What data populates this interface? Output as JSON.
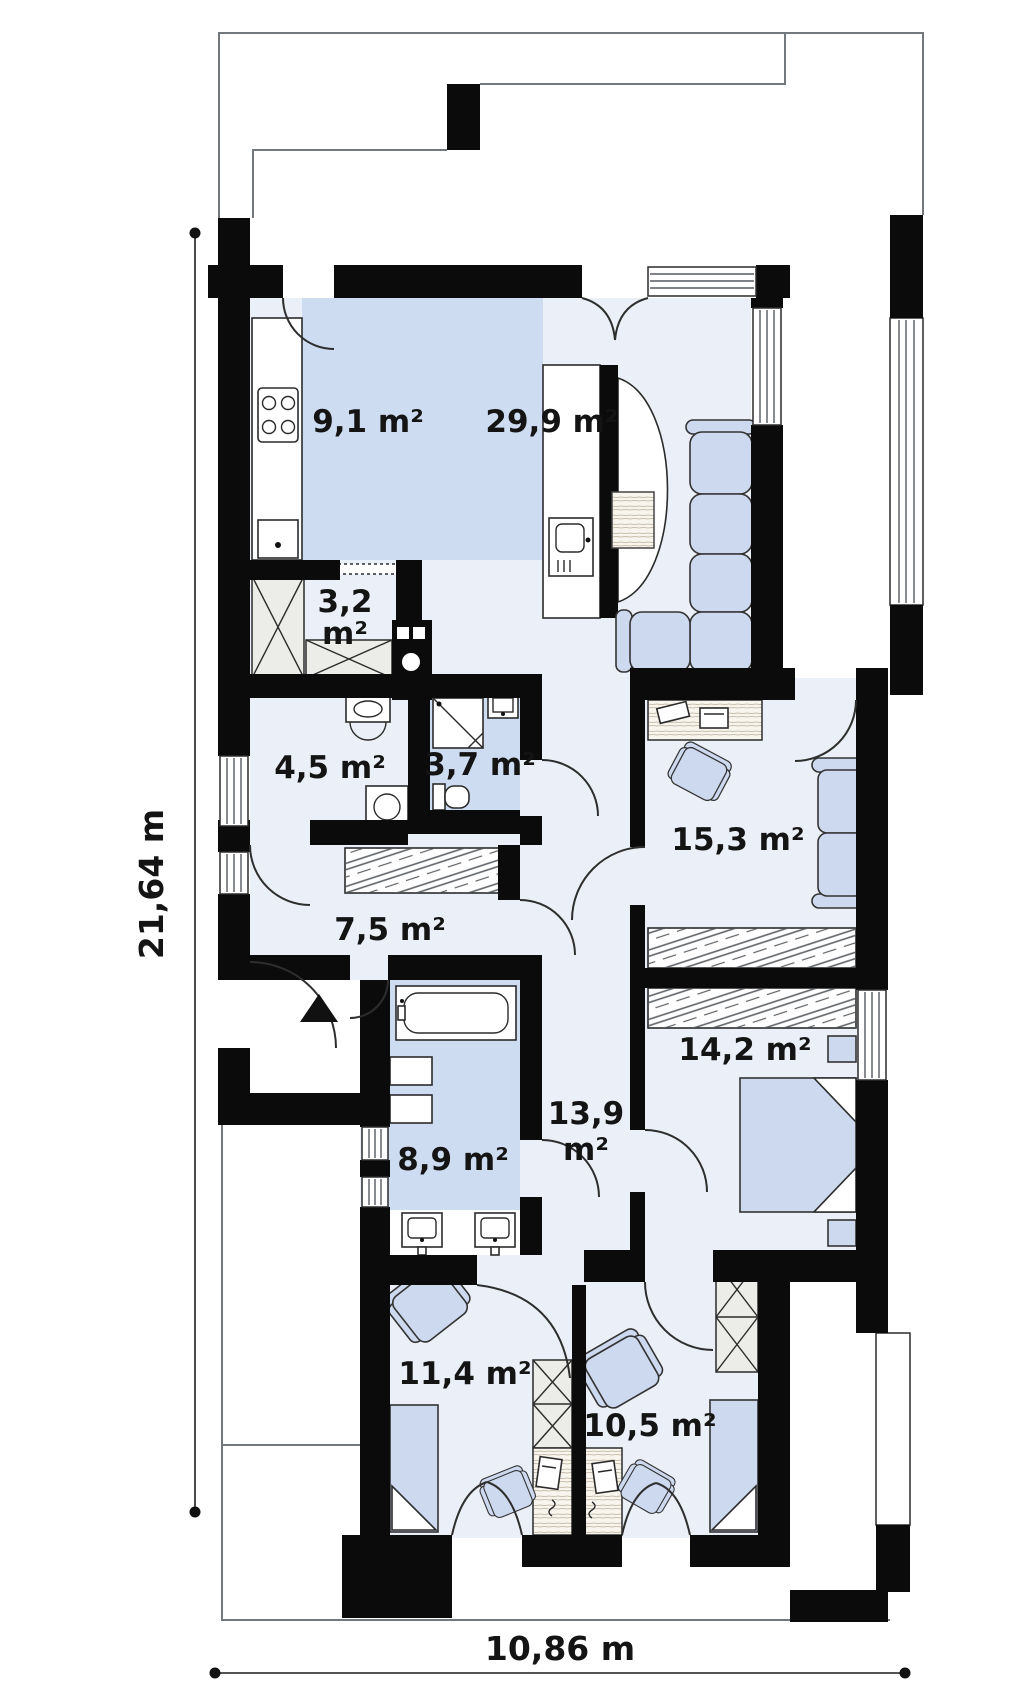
{
  "page": {
    "title": "Single-storey house floor plan"
  },
  "dimensions": {
    "height_label": "21,64 m",
    "width_label": "10,86 m"
  },
  "rooms": [
    {
      "id": "kitchen",
      "label": "9,1 m²"
    },
    {
      "id": "living-room",
      "label": "29,9 m²"
    },
    {
      "id": "pantry",
      "label": "3,2",
      "label2": "m²"
    },
    {
      "id": "utility-room",
      "label": "4,5 m²"
    },
    {
      "id": "shower-room",
      "label": "3,7 m²"
    },
    {
      "id": "hall",
      "label": "7,5 m²"
    },
    {
      "id": "office",
      "label": "15,3 m²"
    },
    {
      "id": "corridor",
      "label": "13,9",
      "label2": "m²"
    },
    {
      "id": "bedroom",
      "label": "14,2 m²"
    },
    {
      "id": "bathroom",
      "label": "8,9 m²"
    },
    {
      "id": "child-room-1",
      "label": "11,4 m²"
    },
    {
      "id": "child-room-2",
      "label": "10,5 m²"
    }
  ],
  "colors": {
    "wall": "#0b0b0b",
    "room_base": "#ebeff7",
    "room_blue": "#cddcf0",
    "furniture_blue": "#cdd9ee",
    "outline_gray": "#73787d"
  }
}
